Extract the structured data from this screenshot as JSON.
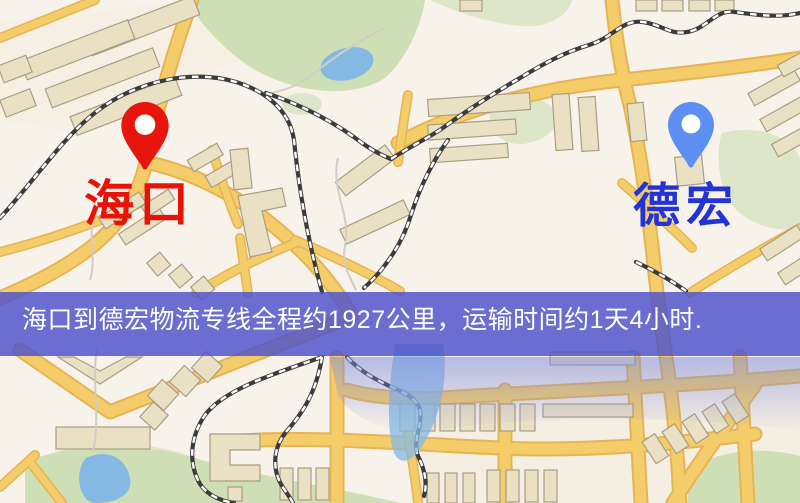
{
  "banner": {
    "text": "海口到德宏物流专线全程约1927公里，运输时间约1天4小时.",
    "bg_color": "#5054cb",
    "text_color": "#ffffff"
  },
  "markers": {
    "origin": {
      "label": "海口",
      "pin_icon": "red-location-pin",
      "pin_color": "#e8150c",
      "label_color": "#e81208"
    },
    "destination": {
      "label": "德宏",
      "pin_icon": "blue-location-pin",
      "pin_color": "#5d8ff2",
      "label_color": "#2433d6"
    }
  },
  "map": {
    "colors": {
      "background": "#f7f2ea",
      "road": "#f4cd6a",
      "road_casing": "#e6b455",
      "building": "#eae0c4",
      "building_stroke": "#a89e84",
      "green": "#cfdfb5",
      "water": "#85b9e3",
      "railway": "#3b3b3b"
    }
  }
}
